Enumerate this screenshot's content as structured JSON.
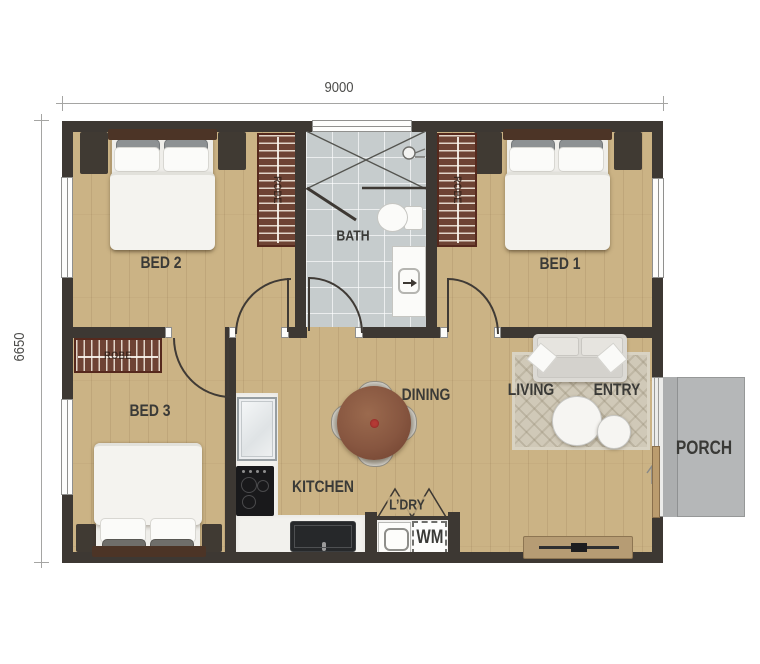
{
  "dimensions": {
    "width_label": "9000",
    "depth_label": "6650"
  },
  "rooms": {
    "bed1": "BED 1",
    "bed2": "BED 2",
    "bed3": "BED 3",
    "bath": "BATH",
    "dining": "DINING",
    "kitchen": "KITCHEN",
    "living": "LIVING",
    "entry": "ENTRY",
    "porch": "PORCH",
    "laundry": "L’DRY",
    "washing_machine": "WM",
    "robe": "ROBE"
  },
  "colors": {
    "wall": "#3d3833",
    "wood_floor": "#cbb385",
    "bath_tile": "#c6cccd",
    "porch_concrete": "#b5b7b8",
    "robe_wood": "#6e4334",
    "dining_table_wood": "#875640",
    "label_text": "#3a3a37",
    "dimension_line": "#a5a5a3"
  }
}
